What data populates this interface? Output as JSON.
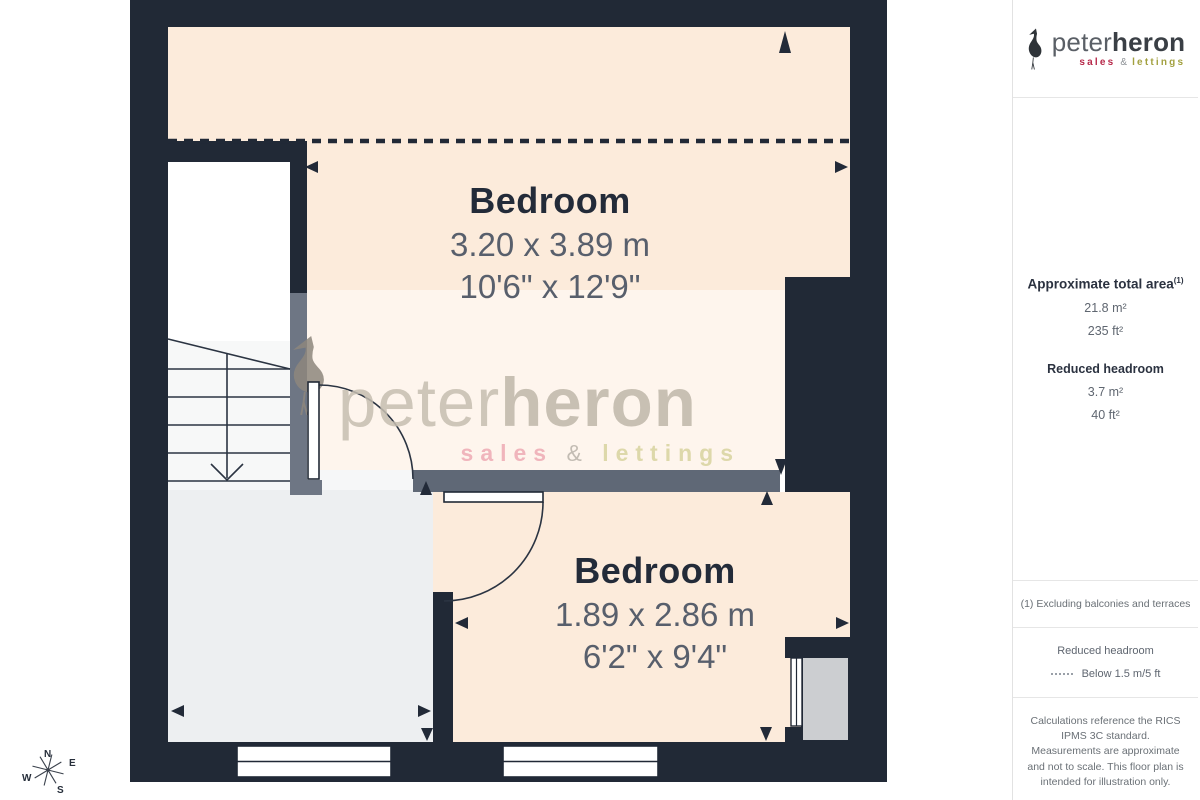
{
  "plan": {
    "rooms": [
      {
        "name": "Bedroom",
        "dim_m": "3.20 x 3.89 m",
        "dim_ft": "10'6\" x 12'9\""
      },
      {
        "name": "Bedroom",
        "dim_m": "1.89 x 2.86 m",
        "dim_ft": "6'2\" x 9'4\""
      }
    ],
    "compass": {
      "n": "N",
      "e": "E",
      "s": "S",
      "w": "W"
    }
  },
  "watermark": {
    "brand_first": "peter",
    "brand_second": "heron",
    "sales": "sales",
    "amp": "&",
    "lettings": "lettings"
  },
  "sidebar": {
    "logo": {
      "brand_first": "peter",
      "brand_second": "heron",
      "sales": "sales",
      "amp": "&",
      "lettings": "lettings"
    },
    "area": {
      "title": "Approximate total area",
      "title_sup": "(1)",
      "m2": "21.8 m²",
      "ft2": "235 ft²"
    },
    "reduced": {
      "title": "Reduced headroom",
      "m2": "3.7 m²",
      "ft2": "40 ft²"
    },
    "note": "(1) Excluding balconies and terraces",
    "legend": {
      "title": "Reduced headroom",
      "label": "Below 1.5 m/5 ft"
    },
    "disclaimer": "Calculations reference the RICS IPMS 3C standard. Measurements are approximate and not to scale. This floor plan is intended for illustration only.",
    "brand_footer": {
      "first": "GIRAFFE",
      "second": "360"
    }
  },
  "colors": {
    "wall_dark": "#212936",
    "wall_reduced": "#6e7684",
    "room_fill": "#fcebdb",
    "floor_fill": "#edeff1",
    "brand_red": "#b7294a",
    "brand_olive": "#a3a140"
  }
}
